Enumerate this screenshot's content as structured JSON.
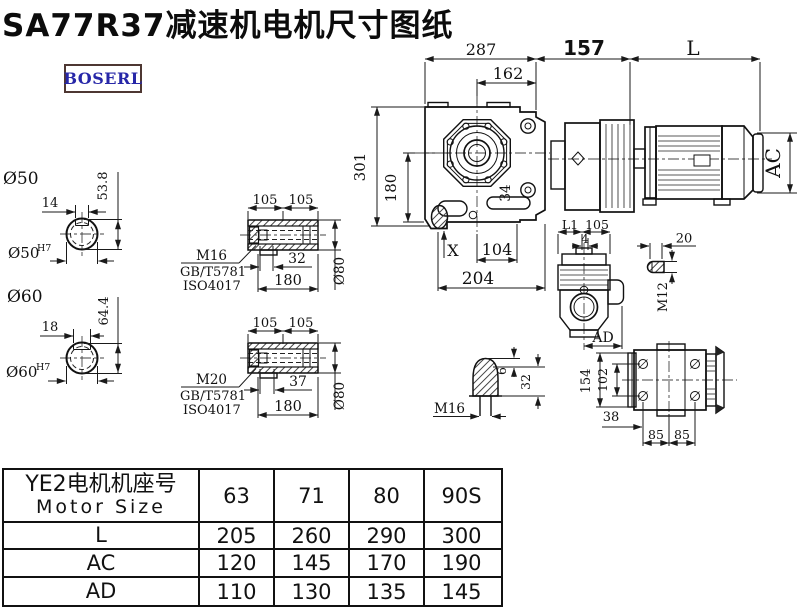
{
  "title": "SA77R37减速机电机尺寸图纸",
  "brand": "BOSERL",
  "colors": {
    "line": "#1a1a1a",
    "brand_text": "#2727a8",
    "brand_border": "#4e3732"
  },
  "drawing": {
    "main_view": {
      "w287": "287",
      "w162": "162",
      "w157": "157",
      "wL": "L",
      "h301": "301",
      "h180": "180",
      "d34": "34",
      "x_mark": "X",
      "w104": "104",
      "w204": "204",
      "hAC": "AC"
    },
    "shaft_end_50": {
      "label": "Ø50",
      "key_width": "14",
      "key_height": "53.8",
      "bore": "Ø50",
      "bore_tol": "H7"
    },
    "shaft_end_60": {
      "label": "Ø60",
      "key_width": "18",
      "key_height": "64.4",
      "bore": "Ø60",
      "bore_tol": "H7"
    },
    "hollow_shaft_top": {
      "w105a": "105",
      "w105b": "105",
      "bolt": "M16",
      "std1": "GB/T5781",
      "std2": "ISO4017",
      "w32": "32",
      "w180": "180",
      "dia": "Ø80"
    },
    "hollow_shaft_bottom": {
      "w105a": "105",
      "w105b": "105",
      "bolt": "M20",
      "std1": "GB/T5781",
      "std2": "ISO4017",
      "w37": "37",
      "w180": "180",
      "dia": "Ø80"
    },
    "side_view": {
      "wL1": "L1",
      "w105": "105",
      "w4": "4",
      "wAD": "AD"
    },
    "plug_detail": {
      "w20": "20",
      "thread": "M12"
    },
    "breather_detail": {
      "thread": "M16",
      "h6": "6",
      "h32": "32"
    },
    "rear_view": {
      "h154": "154",
      "h102": "102",
      "w38": "38",
      "w85a": "85",
      "w85b": "85"
    }
  },
  "table": {
    "header_cn": "YE2电机机座号",
    "header_en": "Motor Size",
    "sizes": [
      "63",
      "71",
      "80",
      "90S"
    ],
    "rows": [
      {
        "label": "L",
        "values": [
          "205",
          "260",
          "290",
          "300"
        ]
      },
      {
        "label": "AC",
        "values": [
          "120",
          "145",
          "170",
          "190"
        ]
      },
      {
        "label": "AD",
        "values": [
          "110",
          "130",
          "135",
          "145"
        ]
      }
    ]
  }
}
